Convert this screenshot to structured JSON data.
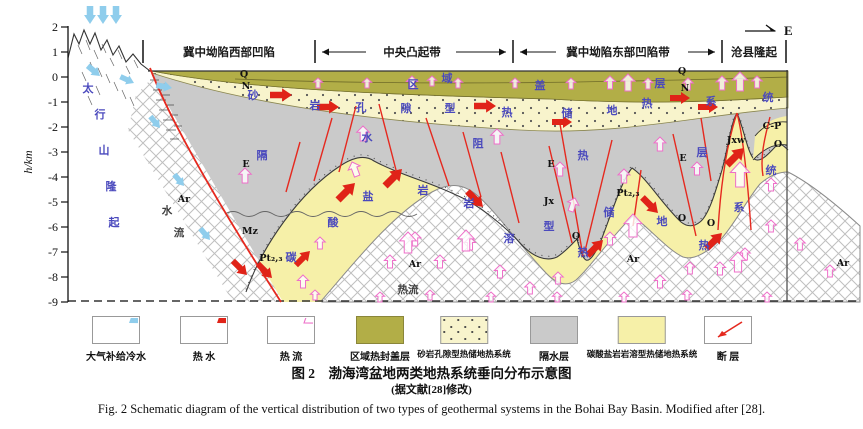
{
  "header": {
    "zones": [
      "冀中坳陷西部凹陷",
      "中央凸起带",
      "冀中坳陷东部凹陷带",
      "沧县隆起"
    ],
    "direction": "E"
  },
  "axis": {
    "label": "h/km",
    "ticks": [
      "2",
      "1",
      "0",
      "-1",
      "-2",
      "-3",
      "-4",
      "-5",
      "-6",
      "-7",
      "-8",
      "-9"
    ]
  },
  "annotations": [
    {
      "t": "太",
      "x": 88,
      "y": 92,
      "c": "b"
    },
    {
      "t": "行",
      "x": 100,
      "y": 118,
      "c": "b"
    },
    {
      "t": "山",
      "x": 104,
      "y": 154,
      "c": "b"
    },
    {
      "t": "隆",
      "x": 111,
      "y": 190,
      "c": "b"
    },
    {
      "t": "起",
      "x": 114,
      "y": 226,
      "c": "b"
    },
    {
      "t": "区",
      "x": 413,
      "y": 88,
      "c": "b"
    },
    {
      "t": "域",
      "x": 447,
      "y": 82,
      "c": "b"
    },
    {
      "t": "盖",
      "x": 540,
      "y": 89,
      "c": "b"
    },
    {
      "t": "层",
      "x": 660,
      "y": 87,
      "c": "b"
    },
    {
      "t": "砂",
      "x": 253,
      "y": 99,
      "c": "b"
    },
    {
      "t": "岩",
      "x": 315,
      "y": 109,
      "c": "b"
    },
    {
      "t": "孔",
      "x": 361,
      "y": 111,
      "c": "b"
    },
    {
      "t": "隙",
      "x": 406,
      "y": 112,
      "c": "b"
    },
    {
      "t": "型",
      "x": 450,
      "y": 112,
      "c": "b"
    },
    {
      "t": "热",
      "x": 507,
      "y": 116,
      "c": "b"
    },
    {
      "t": "储",
      "x": 567,
      "y": 117,
      "c": "b"
    },
    {
      "t": "地",
      "x": 612,
      "y": 114,
      "c": "b"
    },
    {
      "t": "热",
      "x": 647,
      "y": 107,
      "c": "b"
    },
    {
      "t": "系",
      "x": 711,
      "y": 105,
      "c": "b"
    },
    {
      "t": "统",
      "x": 768,
      "y": 101,
      "c": "b"
    },
    {
      "t": "隔",
      "x": 262,
      "y": 159,
      "c": "b"
    },
    {
      "t": "水",
      "x": 367,
      "y": 141,
      "c": "b"
    },
    {
      "t": "阻",
      "x": 478,
      "y": 147,
      "c": "b"
    },
    {
      "t": "热",
      "x": 583,
      "y": 159,
      "c": "b"
    },
    {
      "t": "层",
      "x": 702,
      "y": 156,
      "c": "b"
    },
    {
      "t": "碳",
      "x": 291,
      "y": 261,
      "c": "b"
    },
    {
      "t": "酸",
      "x": 333,
      "y": 226,
      "c": "b"
    },
    {
      "t": "盐",
      "x": 368,
      "y": 200,
      "c": "b"
    },
    {
      "t": "岩",
      "x": 423,
      "y": 194,
      "c": "b"
    },
    {
      "t": "岩",
      "x": 469,
      "y": 207,
      "c": "b"
    },
    {
      "t": "溶",
      "x": 509,
      "y": 242,
      "c": "b"
    },
    {
      "t": "型",
      "x": 549,
      "y": 230,
      "c": "b"
    },
    {
      "t": "热",
      "x": 583,
      "y": 256,
      "c": "b"
    },
    {
      "t": "储",
      "x": 609,
      "y": 216,
      "c": "b"
    },
    {
      "t": "地",
      "x": 662,
      "y": 225,
      "c": "b"
    },
    {
      "t": "热",
      "x": 704,
      "y": 249,
      "c": "b"
    },
    {
      "t": "系",
      "x": 739,
      "y": 211,
      "c": "b"
    },
    {
      "t": "统",
      "x": 771,
      "y": 174,
      "c": "b"
    },
    {
      "t": "水",
      "x": 167,
      "y": 214,
      "c": "w"
    },
    {
      "t": "流",
      "x": 179,
      "y": 236,
      "c": "w"
    },
    {
      "t": "热流",
      "x": 408,
      "y": 293,
      "c": "w"
    },
    {
      "t": "Q",
      "x": 244,
      "y": 77,
      "c": "s"
    },
    {
      "t": "N",
      "x": 246,
      "y": 89,
      "c": "s"
    },
    {
      "t": "Q",
      "x": 682,
      "y": 74,
      "c": "s"
    },
    {
      "t": "N",
      "x": 685,
      "y": 91,
      "c": "s"
    },
    {
      "t": "E",
      "x": 246,
      "y": 167,
      "c": "s"
    },
    {
      "t": "E",
      "x": 551,
      "y": 167,
      "c": "s"
    },
    {
      "t": "E",
      "x": 683,
      "y": 161,
      "c": "s"
    },
    {
      "t": "Mz",
      "x": 250,
      "y": 234,
      "c": "s"
    },
    {
      "t": "Ar",
      "x": 184,
      "y": 202,
      "c": "s"
    },
    {
      "t": "Ar",
      "x": 415,
      "y": 267,
      "c": "s"
    },
    {
      "t": "Ar",
      "x": 633,
      "y": 262,
      "c": "s"
    },
    {
      "t": "Ar",
      "x": 843,
      "y": 266,
      "c": "s"
    },
    {
      "t": "Pt₂,₃",
      "x": 271,
      "y": 261,
      "c": "s"
    },
    {
      "t": "Pt₂,₃",
      "x": 628,
      "y": 196,
      "c": "s"
    },
    {
      "t": "Jx",
      "x": 549,
      "y": 204,
      "c": "s"
    },
    {
      "t": "Jxw",
      "x": 736,
      "y": 143,
      "c": "s"
    },
    {
      "t": "C-P",
      "x": 772,
      "y": 129,
      "c": "s"
    },
    {
      "t": "O",
      "x": 778,
      "y": 147,
      "c": "s"
    },
    {
      "t": "O",
      "x": 682,
      "y": 221,
      "c": "s"
    },
    {
      "t": "O",
      "x": 711,
      "y": 226,
      "c": "s"
    },
    {
      "t": "Q",
      "x": 576,
      "y": 239,
      "c": "s"
    }
  ],
  "legend": [
    {
      "label": "大气补给冷水",
      "kind": "arrow-blue"
    },
    {
      "label": "热  水",
      "kind": "arrow-red"
    },
    {
      "label": "热  流",
      "kind": "arrow-pink"
    },
    {
      "label": "区域热封盖层",
      "kind": "swatch-olive"
    },
    {
      "label": "砂岩孔隙型热储地热系统",
      "kind": "swatch-dotted"
    },
    {
      "label": "隔水层",
      "kind": "swatch-gray"
    },
    {
      "label": "碳酸盐岩岩溶型热储地热系统",
      "kind": "swatch-yellow"
    },
    {
      "label": "断  层",
      "kind": "fault"
    }
  ],
  "captions": {
    "cn_title": "图 2　渤海湾盆地两类地热系统垂向分布示意图",
    "cn_note": "(据文献[28]修改)",
    "en": "Fig. 2   Schematic diagram of the vertical distribution of two types of geothermal systems in the Bohai Bay Basin. Modified after [28]."
  },
  "colors": {
    "cap_olive": "#b2ae47",
    "sandstone_bg": "#f8f4cc",
    "aquitard_gray": "#cacaca",
    "carbonate_yellow": "#f6f0a8",
    "fault_red": "#e5291f",
    "hot_water_red": "#e02318",
    "heat_flow_pink": "#ee6fc9",
    "cold_water_blue": "#8fcdec",
    "label_blue": "#4a49bd"
  }
}
